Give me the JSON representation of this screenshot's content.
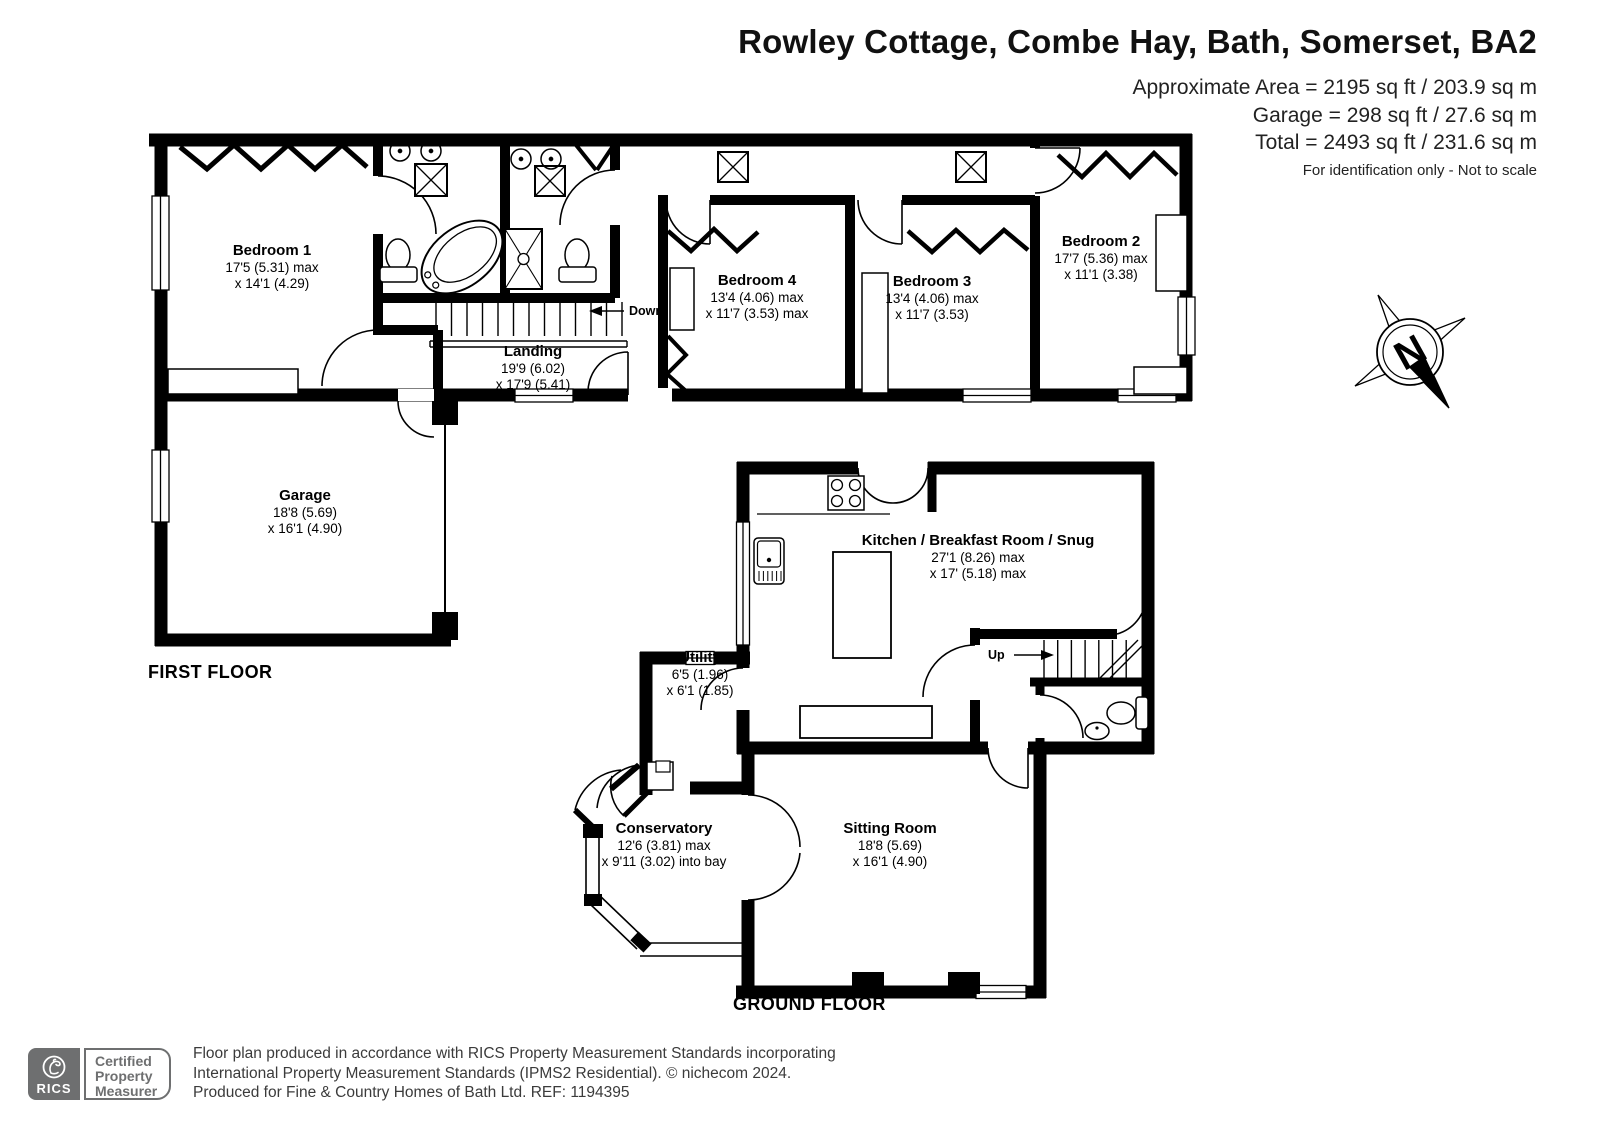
{
  "header": {
    "title": "Rowley Cottage, Combe Hay, Bath, Somerset, BA2",
    "area1": "Approximate Area = 2195 sq ft / 203.9 sq m",
    "area2": "Garage = 298 sq ft / 27.6 sq m",
    "area3": "Total = 2493 sq ft / 231.6 sq m",
    "disclaimer": "For identification only - Not to scale"
  },
  "first_floor": {
    "label": "FIRST FLOOR",
    "down_label": "Down",
    "rooms": {
      "bedroom1": {
        "name": "Bedroom 1",
        "dim1": "17'5 (5.31) max",
        "dim2": "x 14'1 (4.29)"
      },
      "bedroom4": {
        "name": "Bedroom 4",
        "dim1": "13'4 (4.06) max",
        "dim2": "x 11'7 (3.53) max"
      },
      "bedroom3": {
        "name": "Bedroom 3",
        "dim1": "13'4 (4.06) max",
        "dim2": "x 11'7 (3.53)"
      },
      "bedroom2": {
        "name": "Bedroom 2",
        "dim1": "17'7 (5.36) max",
        "dim2": "x 11'1 (3.38)"
      },
      "landing": {
        "name": "Landing",
        "dim1": "19'9 (6.02)",
        "dim2": "x 17'9 (5.41)"
      },
      "garage": {
        "name": "Garage",
        "dim1": "18'8 (5.69)",
        "dim2": "x 16'1 (4.90)"
      }
    }
  },
  "ground_floor": {
    "label": "GROUND FLOOR",
    "up_label": "Up",
    "rooms": {
      "kitchen": {
        "name": "Kitchen / Breakfast Room / Snug",
        "dim1": "27'1 (8.26) max",
        "dim2": "x 17' (5.18) max"
      },
      "utility": {
        "name": "Utility",
        "dim1": "6'5 (1.96)",
        "dim2": "x 6'1 (1.85)"
      },
      "conservatory": {
        "name": "Conservatory",
        "dim1": "12'6 (3.81) max",
        "dim2": "x 9'11 (3.02) into bay"
      },
      "sitting_room": {
        "name": "Sitting Room",
        "dim1": "18'8 (5.69)",
        "dim2": "x 16'1 (4.90)"
      }
    }
  },
  "compass": {
    "north_label": "N"
  },
  "footer": {
    "rics": "RICS",
    "badge1": "Certified",
    "badge2": "Property",
    "badge3": "Measurer",
    "line1": "Floor plan produced in accordance with RICS Property Measurement Standards incorporating",
    "line2": "International Property Measurement Standards (IPMS2 Residential).   © nichecom 2024.",
    "line3": "Produced for Fine & Country Homes of Bath Ltd.   REF:  1194395"
  },
  "colors": {
    "wall": "#000000",
    "logo_gray": "#6e6f70"
  }
}
